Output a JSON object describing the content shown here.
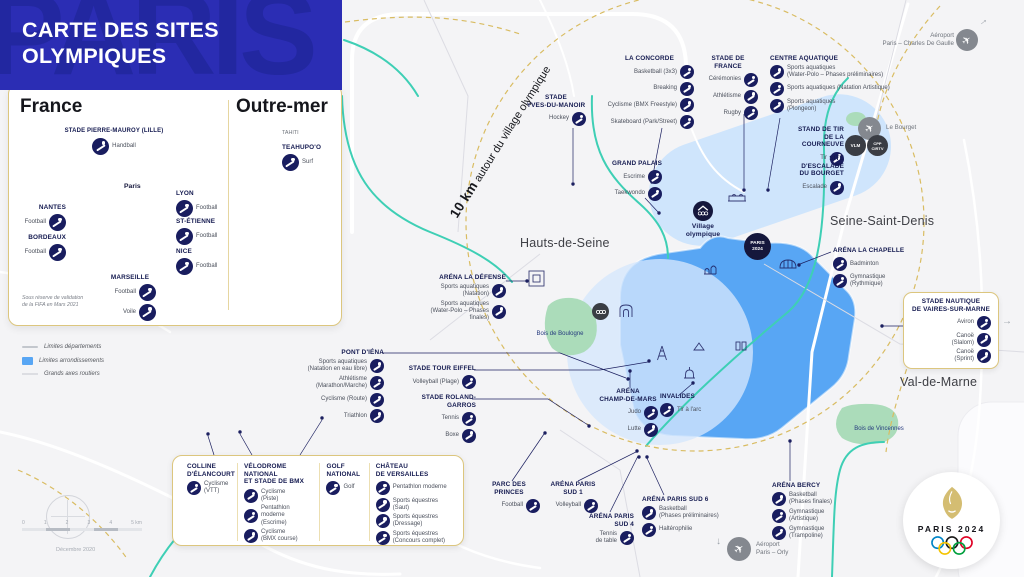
{
  "colors": {
    "header_blue": "#2b2db4",
    "icon_navy": "#191d5f",
    "paris_zone_blue": "#58a6f4",
    "light_zone_blue": "#cfe5fc",
    "gold": "#d9bc62",
    "teal": "#3ecfb5",
    "park_green": "#abdcba",
    "airport_gray": "#84888f",
    "background": "#f4f4f6"
  },
  "header": {
    "title": "CARTE DES SITES\nOLYMPIQUES",
    "ghost": "PARIS"
  },
  "france": {
    "title": "France",
    "paris": "Paris",
    "footnote": "Sous réserve de validation\nde la FIFA en Mars 2021",
    "sites": {
      "lille": {
        "name": "STADE PIERRE-MAUROY (LILLE)",
        "sports": [
          {
            "label": "Handball",
            "icon": "handball-icon"
          }
        ]
      },
      "nantes": {
        "name": "NANTES",
        "sports": [
          {
            "label": "Football",
            "icon": "football-icon"
          }
        ]
      },
      "bordeaux": {
        "name": "BORDEAUX",
        "sports": [
          {
            "label": "Football",
            "icon": "football-icon"
          }
        ]
      },
      "lyon": {
        "name": "LYON",
        "sports": [
          {
            "label": "Football",
            "icon": "football-icon"
          }
        ]
      },
      "st_etienne": {
        "name": "ST-ÉTIENNE",
        "sports": [
          {
            "label": "Football",
            "icon": "football-icon"
          }
        ]
      },
      "nice": {
        "name": "NICE",
        "sports": [
          {
            "label": "Football",
            "icon": "football-icon"
          }
        ]
      },
      "marseille": {
        "name": "MARSEILLE",
        "sports": [
          {
            "label": "Football",
            "icon": "football-icon"
          },
          {
            "label": "Voile",
            "icon": "sailing-icon"
          }
        ]
      }
    }
  },
  "outre_mer": {
    "title": "Outre-mer",
    "region": "TAHITI",
    "site": {
      "name": "TEAHUPO'O",
      "sports": [
        {
          "label": "Surf",
          "icon": "surf-icon"
        }
      ]
    }
  },
  "legend": {
    "items": [
      {
        "label": "Limites départements"
      },
      {
        "label": "Limites arrondissements"
      },
      {
        "label": "Grands axes routiers"
      }
    ]
  },
  "map": {
    "circle_label_strong": "10 km",
    "circle_label_rest": " autour du village olympique",
    "regions": {
      "hauts_de_seine": "Hauts-de-Seine",
      "seine_saint_denis": "Seine-Saint-Denis",
      "val_de_marne": "Val-de-Marne"
    },
    "woods": {
      "boulogne": "Bois de Boulogne",
      "vincennes": "Bois de Vincennes"
    },
    "airports": {
      "cdg": "Aéroport\nParis – Charles De Gaulle",
      "orly": "Aéroport\nParis – Orly",
      "bourget": "Le Bourget"
    },
    "badges": {
      "vlm": "VLM",
      "cpp": "CPP\nCIRTV",
      "paris_2024": "PARIS\n2024"
    },
    "airplane_glyph": "✈",
    "arrow_right": "→",
    "arrow_down": "↓"
  },
  "venues": {
    "yves_du_manoir": {
      "name": "STADE\nYVES-DU-MANOIR",
      "sports": [
        {
          "label": "Hockey",
          "icon": "hockey-icon"
        }
      ]
    },
    "la_concorde": {
      "name": "LA CONCORDE",
      "sports": [
        {
          "label": "Basketball (3x3)",
          "icon": "basketball-3x3-icon"
        },
        {
          "label": "Breaking",
          "icon": "breaking-icon"
        },
        {
          "label": "Cyclisme (BMX Freestyle)",
          "icon": "bmx-freestyle-icon"
        },
        {
          "label": "Skateboard (Park/Street)",
          "icon": "skateboard-icon"
        }
      ]
    },
    "stade_de_france": {
      "name": "STADE DE FRANCE",
      "sports": [
        {
          "label": "Cérémonies",
          "icon": "ceremonies-icon"
        },
        {
          "label": "Athlétisme",
          "icon": "athletics-icon"
        },
        {
          "label": "Rugby",
          "icon": "rugby-icon"
        }
      ]
    },
    "centre_aquatique": {
      "name": "CENTRE AQUATIQUE",
      "sports": [
        {
          "label": "Sports aquatiques\n(Water-Polo – Phases préliminaires)",
          "icon": "water-polo-icon"
        },
        {
          "label": "Sports aquatiques (Natation Artistique)",
          "icon": "artistic-swimming-icon"
        },
        {
          "label": "Sports aquatiques\n(Plongeon)",
          "icon": "diving-icon"
        }
      ]
    },
    "stand_tir_courneuve": {
      "name": "STAND DE TIR\nDE LA COURNEUVE",
      "sports": [
        {
          "label": "Tir",
          "icon": "shooting-icon"
        }
      ]
    },
    "site_escalade_bourget": {
      "name": "SITE D'ESCALADE\nDU BOURGET",
      "sports": [
        {
          "label": "Escalade",
          "icon": "climbing-icon"
        }
      ]
    },
    "grand_palais": {
      "name": "GRAND PALAIS",
      "sports": [
        {
          "label": "Escrime",
          "icon": "fencing-icon"
        },
        {
          "label": "Taekwondo",
          "icon": "taekwondo-icon"
        }
      ]
    },
    "village_olympique": {
      "name": "Village\nolympique"
    },
    "arena_la_chapelle": {
      "name": "ARÉNA LA CHAPELLE",
      "sports": [
        {
          "label": "Badminton",
          "icon": "badminton-icon"
        },
        {
          "label": "Gymnastique\n(Rythmique)",
          "icon": "rhythmic-gymnastics-icon"
        }
      ]
    },
    "arena_la_defense": {
      "name": "ARÉNA LA DÉFENSE",
      "sports": [
        {
          "label": "Sports aquatiques\n(Natation)",
          "icon": "swimming-icon"
        },
        {
          "label": "Sports aquatiques\n(Water-Polo – Phases finales)",
          "icon": "water-polo-icon"
        }
      ]
    },
    "stade_nautique_vaires": {
      "name": "STADE NAUTIQUE\nDE VAIRES-SUR-MARNE",
      "sports": [
        {
          "label": "Aviron",
          "icon": "rowing-icon"
        },
        {
          "label": "Canoë\n(Slalom)",
          "icon": "canoe-slalom-icon"
        },
        {
          "label": "Canoë\n(Sprint)",
          "icon": "canoe-sprint-icon"
        }
      ]
    },
    "pont_d_iena": {
      "name": "PONT D'IÉNA",
      "sports": [
        {
          "label": "Sports aquatiques\n(Natation en eau libre)",
          "icon": "open-water-swimming-icon"
        },
        {
          "label": "Athlétisme\n(Marathon/Marche)",
          "icon": "marathon-icon"
        },
        {
          "label": "Cyclisme (Route)",
          "icon": "road-cycling-icon"
        },
        {
          "label": "Triathlon",
          "icon": "triathlon-icon"
        }
      ]
    },
    "stade_tour_eiffel": {
      "name": "STADE TOUR EIFFEL",
      "sports": [
        {
          "label": "Volleyball (Plage)",
          "icon": "beach-volleyball-icon"
        }
      ]
    },
    "stade_roland_garros": {
      "name": "STADE ROLAND-GARROS",
      "sports": [
        {
          "label": "Tennis",
          "icon": "tennis-icon"
        },
        {
          "label": "Boxe",
          "icon": "boxing-icon"
        }
      ]
    },
    "arena_champ_de_mars": {
      "name": "ARÉNA\nCHAMP-DE-MARS",
      "sports": [
        {
          "label": "Judo",
          "icon": "judo-icon"
        },
        {
          "label": "Lutte",
          "icon": "wrestling-icon"
        }
      ]
    },
    "invalides": {
      "name": "INVALIDES",
      "sports": [
        {
          "label": "Tir à l'arc",
          "icon": "archery-icon"
        }
      ]
    },
    "parc_des_princes": {
      "name": "PARC DES PRINCES",
      "sports": [
        {
          "label": "Football",
          "icon": "football-icon"
        }
      ]
    },
    "arena_paris_sud_1": {
      "name": "ARÉNA PARIS SUD 1",
      "sports": [
        {
          "label": "Volleyball",
          "icon": "volleyball-icon"
        }
      ]
    },
    "arena_paris_sud_4": {
      "name": "ARÉNA PARIS SUD 4",
      "sports": [
        {
          "label": "Tennis\nde table",
          "icon": "table-tennis-icon"
        }
      ]
    },
    "arena_paris_sud_6": {
      "name": "ARÉNA PARIS SUD 6",
      "sports": [
        {
          "label": "Basketball\n(Phases préliminaires)",
          "icon": "basketball-icon"
        },
        {
          "label": "Haltérophilie",
          "icon": "weightlifting-icon"
        }
      ]
    },
    "arena_bercy": {
      "name": "ARÉNA BERCY",
      "sports": [
        {
          "label": "Basketball\n(Phases finales)",
          "icon": "basketball-icon"
        },
        {
          "label": "Gymnastique\n(Artistique)",
          "icon": "artistic-gymnastics-icon"
        },
        {
          "label": "Gymnastique\n(Trampoline)",
          "icon": "trampoline-icon"
        }
      ]
    },
    "colline_elancourt": {
      "name": "COLLINE\nD'ÉLANCOURT",
      "sports": [
        {
          "label": "Cyclisme\n(VTT)",
          "icon": "mountain-bike-icon"
        }
      ]
    },
    "velodrome_national": {
      "name": "VÉLODROME NATIONAL\nET STADE DE BMX",
      "sports": [
        {
          "label": "Cyclisme\n(Piste)",
          "icon": "track-cycling-icon"
        },
        {
          "label": "Pentathlon moderne\n(Escrime)",
          "icon": "modern-pentathlon-icon"
        },
        {
          "label": "Cyclisme\n(BMX course)",
          "icon": "bmx-racing-icon"
        }
      ]
    },
    "golf_national": {
      "name": "GOLF NATIONAL",
      "sports": [
        {
          "label": "Golf",
          "icon": "golf-icon"
        }
      ]
    },
    "chateau_versailles": {
      "name": "CHÂTEAU\nDE VERSAILLES",
      "sports": [
        {
          "label": "Pentathlon moderne",
          "icon": "modern-pentathlon-icon"
        },
        {
          "label": "Sports équestres\n(Saut)",
          "icon": "equestrian-jumping-icon"
        },
        {
          "label": "Sports équestres\n(Dressage)",
          "icon": "equestrian-dressage-icon"
        },
        {
          "label": "Sports équestres\n(Concours complet)",
          "icon": "equestrian-eventing-icon"
        }
      ]
    }
  },
  "scalebar": {
    "ticks": [
      "0",
      "1",
      "2",
      "3",
      "4",
      "5 km"
    ],
    "date": "Décembre 2020"
  },
  "logo": {
    "wordmark": "PARIS 2024"
  }
}
